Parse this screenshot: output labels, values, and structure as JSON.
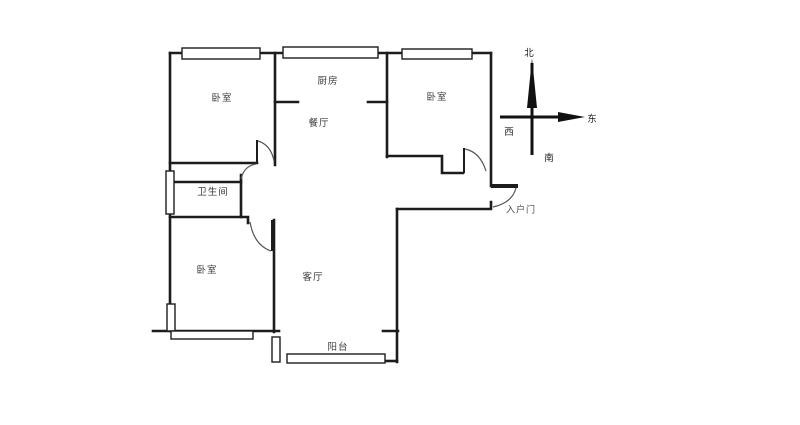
{
  "floorplan": {
    "title": "apartment-floorplan",
    "rooms": [
      {
        "id": "bedroom-top-left",
        "label": "卧室"
      },
      {
        "id": "kitchen",
        "label": "厨房"
      },
      {
        "id": "dining-room",
        "label": "餐厅"
      },
      {
        "id": "bedroom-top-right",
        "label": "卧室"
      },
      {
        "id": "bathroom",
        "label": "卫生间"
      },
      {
        "id": "bedroom-bottom-left",
        "label": "卧室"
      },
      {
        "id": "living-room",
        "label": "客厅"
      },
      {
        "id": "balcony",
        "label": "阳台"
      }
    ],
    "entrance": {
      "label": "入户门"
    },
    "compass": {
      "north": "北",
      "east": "东",
      "west": "西",
      "south": "南"
    },
    "colors": {
      "wall": "#1c1c1c",
      "door_arc": "#555555",
      "background": "#ffffff",
      "text": "#3b3b3b"
    }
  }
}
